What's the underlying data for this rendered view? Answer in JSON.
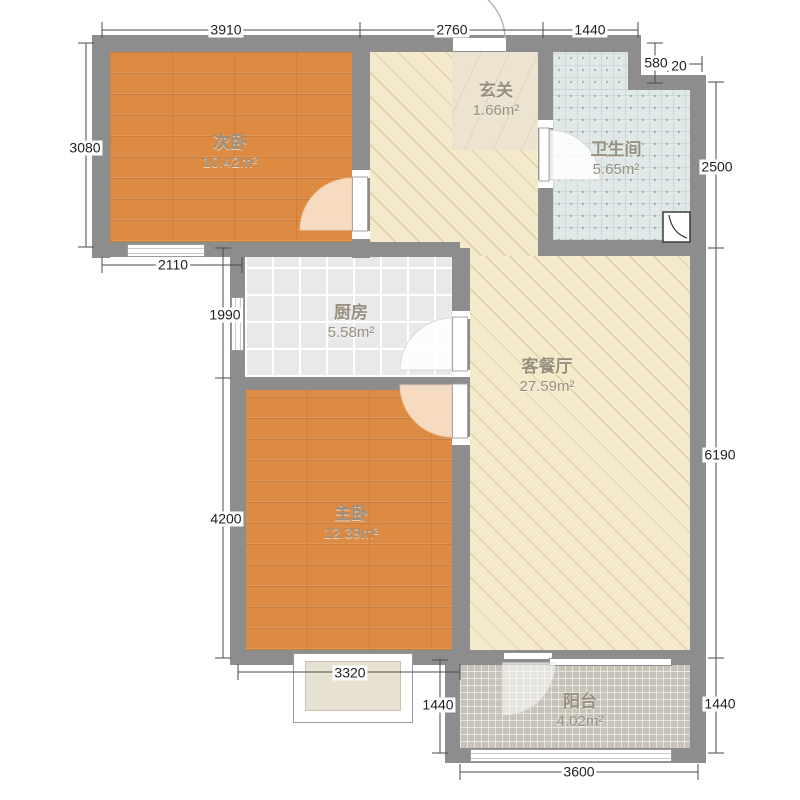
{
  "plan": {
    "rooms": [
      {
        "name": "次卧",
        "area": "10.42m²"
      },
      {
        "name": "玄关",
        "area": "1.66m²"
      },
      {
        "name": "卫生间",
        "area": "5.65m²"
      },
      {
        "name": "厨房",
        "area": "5.58m²"
      },
      {
        "name": "客餐厅",
        "area": "27.59m²"
      },
      {
        "name": "主卧",
        "area": "12.39m²"
      },
      {
        "name": "阳台",
        "area": "4.02m²"
      }
    ],
    "dimensions": {
      "top_3910": "3910",
      "top_2760": "2760",
      "top_1440": "1440",
      "step_580": "580",
      "step_20": "20",
      "right_2500": "2500",
      "right_6190": "6190",
      "right_1440": "1440",
      "bottom_3600": "3600",
      "balcony_left_1440": "1440",
      "master_bottom_3320": "3320",
      "left_4200": "4200",
      "left_1990": "1990",
      "left_2110": "2110",
      "left_3080": "3080"
    },
    "icons": {
      "shower": "shower-drain-quarter-arc"
    },
    "colors": {
      "wall": "#8d8d8d",
      "wood_floor": "#dd8a42",
      "kitchen_tile": "#e9e9e9",
      "bath_tile": "#e0e9e8",
      "living_floor": "#f4eacb",
      "entry_marble": "#ece3d0",
      "balcony_tile": "#c8c3b8",
      "dimension_text": "#1f1f1f",
      "room_label_text": "#98907e"
    }
  }
}
